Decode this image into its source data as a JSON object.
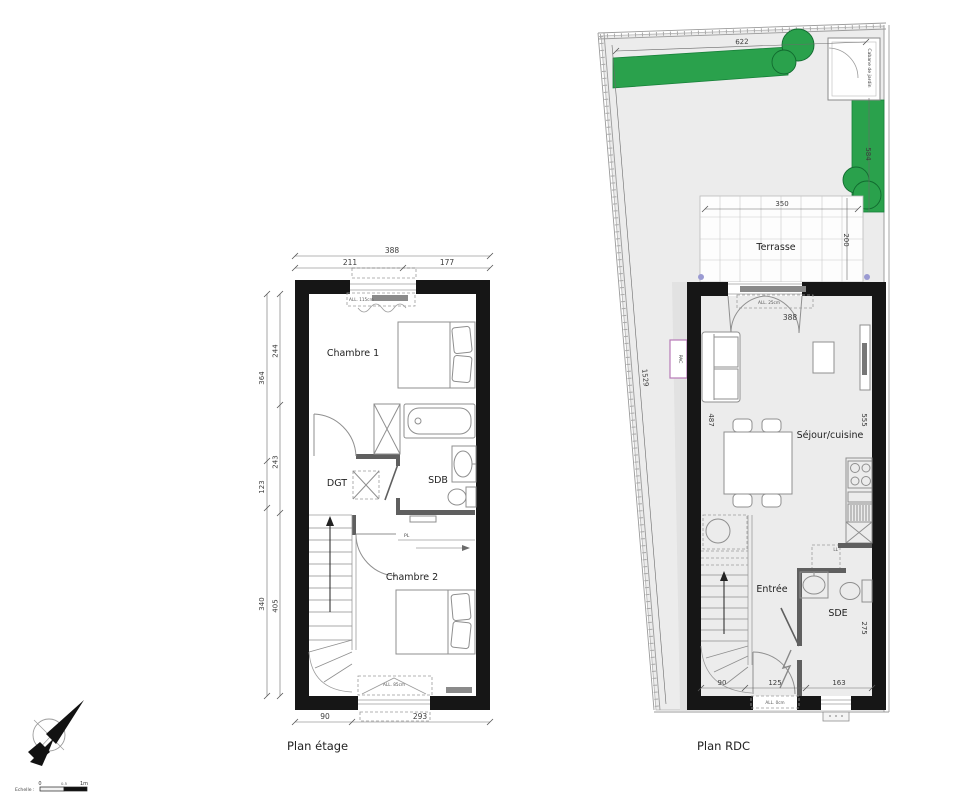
{
  "colors": {
    "wall": "#161616",
    "partition": "#5f5f5f",
    "furniture": "#8f8f8f",
    "hedge_fill": "#2aa14c",
    "hedge_stroke": "#178039",
    "garden_fill": "#ececec",
    "pac_border": "#b77ab7",
    "marker_dot": "#9a9ad2",
    "radiator": "#8a8a8a"
  },
  "etage": {
    "title": "Plan étage",
    "rooms": {
      "chambre1": "Chambre 1",
      "dgt": "DGT",
      "sdb": "SDB",
      "chambre2": "Chambre 2"
    },
    "labels": {
      "window_top": "ALL. 115cm",
      "window_bottom": "ALL. 85cm",
      "closet": "PL"
    },
    "dims": {
      "top_total": "388",
      "top_left": "211",
      "top_right": "177",
      "left_outer": [
        "364",
        "123",
        "340"
      ],
      "left_inner": [
        "244",
        "243",
        "405"
      ],
      "bottom_left": "90",
      "bottom_right": "293"
    }
  },
  "rdc": {
    "title": "Plan RDC",
    "rooms": {
      "terrasse": "Terrasse",
      "sejour": "Séjour/cuisine",
      "entree": "Entrée",
      "sde": "SDE"
    },
    "labels": {
      "cabane": "Cabane de jardin",
      "pac": "PAC",
      "ll": "LL",
      "window_top": "ALL. 25cm",
      "door_bottom": "ALL. 0cm"
    },
    "dims": {
      "garden_top": "622",
      "garden_left": "1529",
      "hedge_right": "584",
      "terrasse_width": "350",
      "terrasse_depth": "200",
      "sejour_width": "388",
      "sejour_depth": "487",
      "kitchen_wall": "555",
      "sde_depth": "275",
      "bottom": [
        "90",
        "125",
        "163"
      ]
    }
  },
  "legend": {
    "scale_label": "Echelle :",
    "tick_0": "0",
    "tick_mid": "0.5",
    "tick_1": "1m"
  }
}
